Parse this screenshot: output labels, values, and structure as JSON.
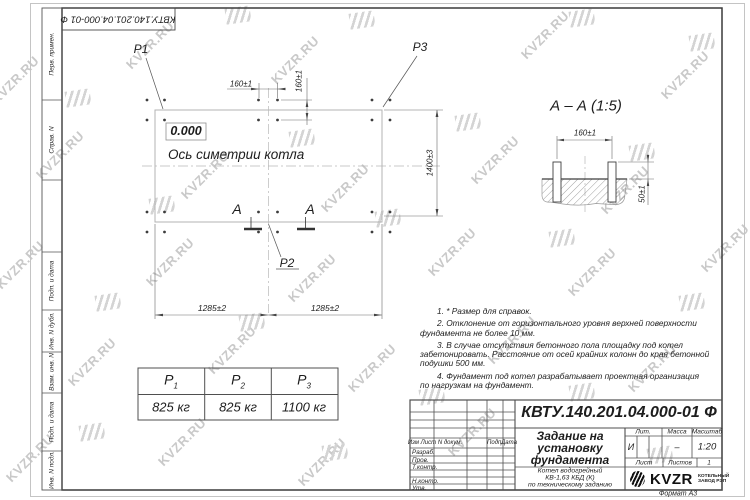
{
  "watermark": {
    "text": "KVZR.RU"
  },
  "stamp_top": "КВТУ.140.201.04.000-01 Ф",
  "sidebar": {
    "labels": [
      "Перв. примен.",
      "Справ. N",
      "Подп. и дата",
      "Инв. N дубл.",
      "Взам. инв. N",
      "Подп. и дата",
      "Инв. N подл."
    ]
  },
  "plan": {
    "p1": "P1",
    "p2": "P2",
    "p3": "P3",
    "elevation": "0.000",
    "axis_label": "Ось симетрии котла",
    "dim_bolt_h": "160±1",
    "dim_bolt_v": "160±1",
    "dim_height": "1400±3",
    "dim_left": "1285±2",
    "dim_right": "1285±2",
    "section_letter": "A"
  },
  "section": {
    "title": "А – А (1:5)",
    "dim_spacing": "160±1",
    "dim_protrusion": "50±1"
  },
  "notes": {
    "lines": [
      "1. * Размер для справок.",
      "2. Отклонение от горизонтального уровня верхней поверхности",
      "фундамента не более 10 мм.",
      "3. В случае отсутствия бетонного пола площадку под котел",
      "забетонировать. Расстояние от осей крайних колонн до края бетонной",
      "подушки 500 мм.",
      "4. Фундамент под котел разрабатывает проектная организация",
      "по нагрузкам на фундамент."
    ]
  },
  "loads_table": {
    "headers": [
      {
        "base": "P",
        "sub": "1"
      },
      {
        "base": "P",
        "sub": "2"
      },
      {
        "base": "P",
        "sub": "3"
      }
    ],
    "values": [
      "825 кг",
      "825 кг",
      "1100 кг"
    ]
  },
  "title_block": {
    "doc_number": "КВТУ.140.201.04.000-01 Ф",
    "title_lines": [
      "Задание на",
      "установку",
      "фундамента"
    ],
    "product_lines": [
      "Котел водогрейный",
      "КВ-1,63 КБД (К)",
      "по техническому заданию"
    ],
    "cols": {
      "izm": "Изм Лист",
      "doc": "N докум.",
      "sign": "Подп.",
      "date": "Дата"
    },
    "rows": [
      "Разраб.",
      "Пров.",
      "Т.контр.",
      "Н.контр.",
      "Утв."
    ],
    "lit_label": "Лит.",
    "mass_label": "Масса",
    "scale_label": "Масштаб",
    "lit_value": "И",
    "mass_value": "–",
    "scale_value": "1:20",
    "sheet_label": "Лист",
    "sheets_label": "Листов",
    "sheets_value": "1",
    "logo": {
      "text": "KVZR",
      "sub_lines": [
        "КОТЕЛЬНЫЙ",
        "ЗАВОД РЭП"
      ]
    },
    "format_label": "Формат А3"
  }
}
